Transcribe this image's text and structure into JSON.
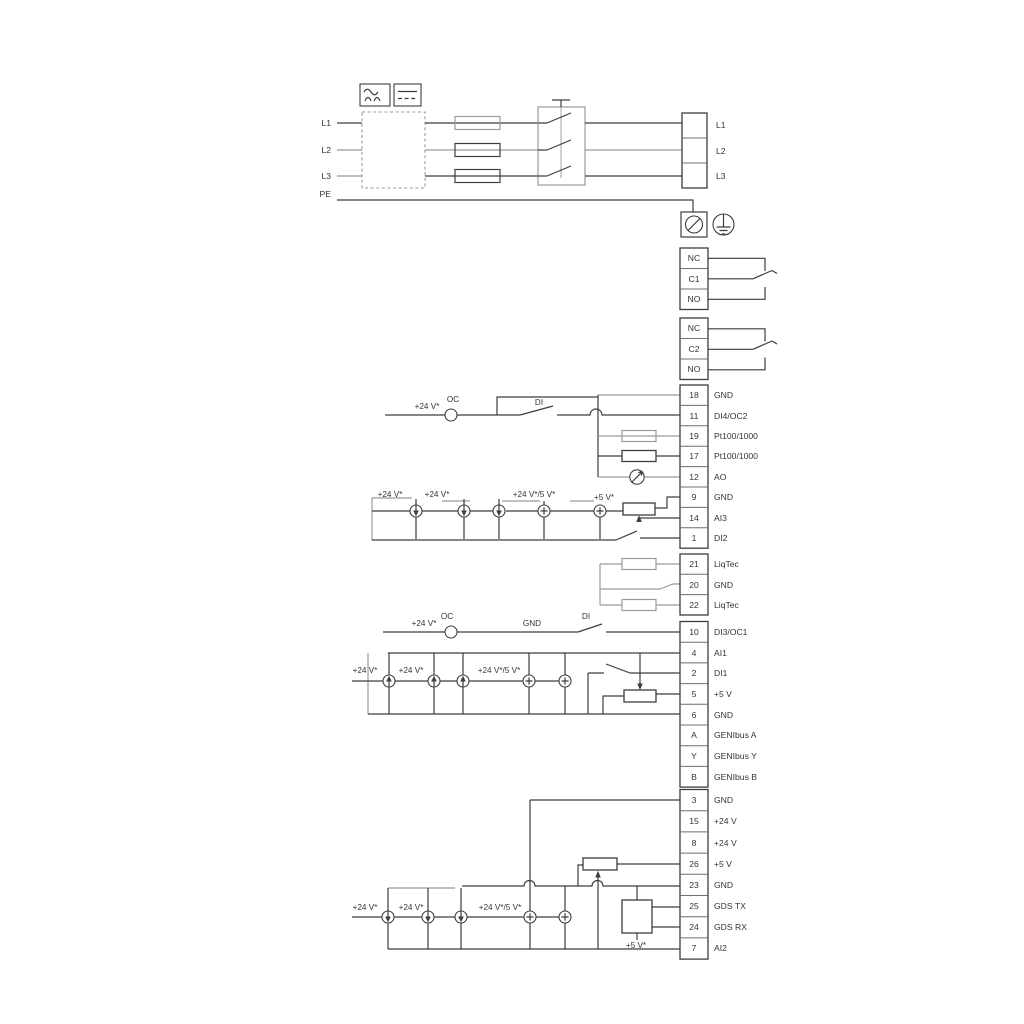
{
  "power": {
    "in": [
      "L1",
      "L2",
      "L3",
      "PE"
    ],
    "out": [
      "L1",
      "L2",
      "L3"
    ]
  },
  "relays": {
    "r1": [
      "NC",
      "C1",
      "NO"
    ],
    "r2": [
      "NC",
      "C2",
      "NO"
    ]
  },
  "g1": {
    "rows": [
      [
        "18",
        "GND"
      ],
      [
        "11",
        "DI4/OC2"
      ],
      [
        "19",
        "Pt100/1000"
      ],
      [
        "17",
        "Pt100/1000"
      ],
      [
        "12",
        "AO"
      ],
      [
        "9",
        "GND"
      ],
      [
        "14",
        "AI3"
      ],
      [
        "1",
        "DI2"
      ]
    ],
    "v24": "+24 V*",
    "oc": "OC",
    "di": "DI",
    "s_v24a": "+24 V*",
    "s_v24b": "+24 V*",
    "s_v245": "+24 V*/5 V*",
    "s_v5": "+5 V*"
  },
  "g2": {
    "rows": [
      [
        "21",
        "LiqTec"
      ],
      [
        "20",
        "GND"
      ],
      [
        "22",
        "LiqTec"
      ]
    ]
  },
  "g3": {
    "rows": [
      [
        "10",
        "DI3/OC1"
      ],
      [
        "4",
        "AI1"
      ],
      [
        "2",
        "DI1"
      ],
      [
        "5",
        "+5 V"
      ],
      [
        "6",
        "GND"
      ],
      [
        "A",
        "GENIbus A"
      ],
      [
        "Y",
        "GENIbus Y"
      ],
      [
        "B",
        "GENIbus B"
      ]
    ],
    "v24": "+24 V*",
    "oc": "OC",
    "gnd": "GND",
    "di": "DI",
    "s_v24a": "+24 V*",
    "s_v24b": "+24 V*",
    "s_v245": "+24 V*/5 V*"
  },
  "g4": {
    "rows": [
      [
        "3",
        "GND"
      ],
      [
        "15",
        "+24 V"
      ],
      [
        "8",
        "+24 V"
      ],
      [
        "26",
        "+5 V"
      ],
      [
        "23",
        "GND"
      ],
      [
        "25",
        "GDS TX"
      ],
      [
        "24",
        "GDS RX"
      ],
      [
        "7",
        "AI2"
      ]
    ],
    "s_v24a": "+24 V*",
    "s_v24b": "+24 V*",
    "s_v245": "+24 V*/5 V*",
    "s_v5": "+5 V*"
  },
  "colors": {
    "wire": "#3d3d3d",
    "wire_grey": "#9b9b9b",
    "text": "#343434",
    "background": "#ffffff"
  }
}
